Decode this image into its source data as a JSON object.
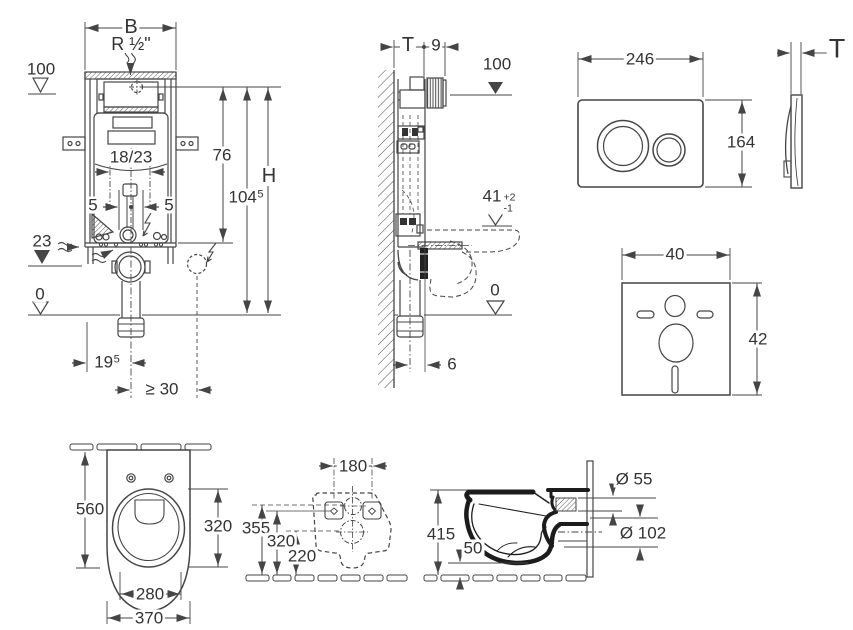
{
  "colors": {
    "line": "#454545",
    "thick": "#1c1c1c",
    "text": "#333333",
    "bg": "#ffffff"
  },
  "front_view": {
    "width_b": "B",
    "supply": "R ½\"",
    "level_100": "100",
    "dim_18_23": "18/23",
    "dim_76": "76",
    "dim_104": {
      "main": "104",
      "sup": "5"
    },
    "height_h": "H",
    "dim_5_left": "5",
    "dim_5_right": "5",
    "level_23": "23",
    "level_0": "0",
    "dim_19": {
      "main": "19",
      "sup": "5"
    },
    "dim_min_30": "≥ 30"
  },
  "side_view": {
    "depth_t": "T",
    "dim_9": "9",
    "level_100": "100",
    "level_41": {
      "main": "41",
      "plus": "+2",
      "minus": "-1"
    },
    "level_0": "0",
    "dim_6": "6"
  },
  "flush_plate": {
    "width": "246",
    "height": "164",
    "thickness_t": "T"
  },
  "insulation_mat": {
    "width": "40",
    "height": "42"
  },
  "plan_view": {
    "depth": "560",
    "bowl_width": "320",
    "rim_width": "280",
    "width": "370"
  },
  "rear_view": {
    "hole_spacing": "180",
    "height_355": "355",
    "height_320": "320",
    "height_220": "220"
  },
  "side_section": {
    "height_415": "415",
    "clearance_50": "50",
    "inlet_dia": "Ø 55",
    "outlet_dia": "Ø 102"
  }
}
